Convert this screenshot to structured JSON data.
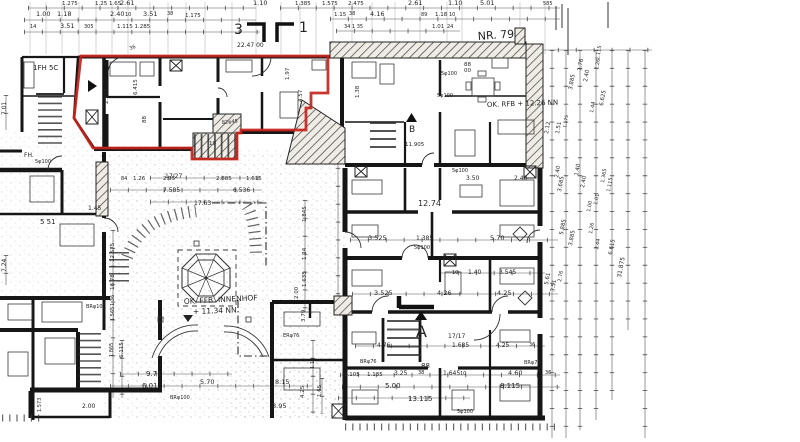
{
  "meta": {
    "sheet": "NR. 79",
    "drawing_type": "hand-drawn floor plan with highlighted unit"
  },
  "colors": {
    "paper": "#ffffff",
    "ink": "#1c1c1c",
    "dim": "#3c3c3c",
    "highlight": "#c6251c"
  },
  "highlight": {
    "points": "81,56 328,56 328,93 311,93 311,108 306,108 306,130 241,130 241,133 237,133 237,159 192,159 192,148 93,148 74,118"
  },
  "labels": [
    {
      "t": "1.275",
      "x": 62,
      "y": 5,
      "s": 5.5
    },
    {
      "t": "1.25 1.65",
      "x": 95,
      "y": 5,
      "s": 5.5
    },
    {
      "t": "2.61",
      "x": 120,
      "y": 5
    },
    {
      "t": "1.10",
      "x": 253,
      "y": 5
    },
    {
      "t": "1.00",
      "x": 36,
      "y": 16
    },
    {
      "t": "1.18",
      "x": 57,
      "y": 16
    },
    {
      "t": "2.40",
      "x": 110,
      "y": 16
    },
    {
      "t": "10",
      "x": 125,
      "y": 16,
      "s": 5
    },
    {
      "t": "3.51",
      "x": 143,
      "y": 16
    },
    {
      "t": "38",
      "x": 167,
      "y": 15,
      "s": 5
    },
    {
      "t": "1.175",
      "x": 185,
      "y": 17,
      "s": 5.5
    },
    {
      "t": "14",
      "x": 30,
      "y": 28,
      "s": 5
    },
    {
      "t": "3.51",
      "x": 60,
      "y": 28
    },
    {
      "t": "305",
      "x": 84,
      "y": 28,
      "s": 5
    },
    {
      "t": "1.115 1.285",
      "x": 117,
      "y": 28,
      "s": 5.5
    },
    {
      "t": "1.385",
      "x": 295,
      "y": 5,
      "s": 5.5
    },
    {
      "t": "1.575",
      "x": 322,
      "y": 5,
      "s": 5.5
    },
    {
      "t": "2.475",
      "x": 348,
      "y": 5,
      "s": 5.5
    },
    {
      "t": "2.61",
      "x": 408,
      "y": 5
    },
    {
      "t": "1.10",
      "x": 448,
      "y": 5
    },
    {
      "t": "5.01",
      "x": 480,
      "y": 5
    },
    {
      "t": "585",
      "x": 543,
      "y": 5,
      "s": 5
    },
    {
      "t": "1.15",
      "x": 334,
      "y": 16,
      "s": 5.5
    },
    {
      "t": "38",
      "x": 349,
      "y": 15,
      "s": 5
    },
    {
      "t": "4.16",
      "x": 370,
      "y": 16
    },
    {
      "t": "89",
      "x": 421,
      "y": 16,
      "s": 5
    },
    {
      "t": "1.18",
      "x": 435,
      "y": 16,
      "s": 5.5
    },
    {
      "t": "10",
      "x": 449,
      "y": 16,
      "s": 5
    },
    {
      "t": "34 1 35",
      "x": 344,
      "y": 28,
      "s": 5
    },
    {
      "t": "1.01",
      "x": 432,
      "y": 28,
      "s": 5.5
    },
    {
      "t": "24",
      "x": 447,
      "y": 28,
      "s": 5
    },
    {
      "t": "3",
      "x": 234,
      "y": 34,
      "s": 14
    },
    {
      "t": "1",
      "x": 299,
      "y": 32,
      "s": 14
    },
    {
      "t": "NR. 79",
      "x": 478,
      "y": 40,
      "s": 11,
      "r": -4
    },
    {
      "t": "22.47 00",
      "x": 237,
      "y": 47,
      "s": 6
    },
    {
      "t": "36",
      "x": 130,
      "y": 50,
      "s": 5,
      "r": -20
    },
    {
      "t": "1FH 5C",
      "x": 33,
      "y": 70,
      "s": 7
    },
    {
      "t": "OK. RFB + 12.26 NN",
      "x": 487,
      "y": 107,
      "s": 7,
      "r": -2
    },
    {
      "t": "B",
      "x": 409,
      "y": 132,
      "s": 9
    },
    {
      "t": "11.905",
      "x": 405,
      "y": 146,
      "s": 5.5
    },
    {
      "t": "OK. FFB. INNENHOF",
      "x": 184,
      "y": 304,
      "s": 7.5,
      "r": -3
    },
    {
      "t": "+ 11.34 NN",
      "x": 193,
      "y": 314,
      "s": 7.5,
      "r": -2
    },
    {
      "t": "A",
      "x": 416,
      "y": 337,
      "s": 16
    },
    {
      "t": "17/27",
      "x": 165,
      "y": 178,
      "s": 6
    },
    {
      "t": "17/17",
      "x": 448,
      "y": 338,
      "s": 6
    },
    {
      "t": "2.185",
      "x": 108,
      "y": 104,
      "r": -90,
      "s": 5.5
    },
    {
      "t": "6.415",
      "x": 137,
      "y": 95,
      "r": -90,
      "s": 5.5
    },
    {
      "t": "88",
      "x": 146,
      "y": 123,
      "r": -90,
      "s": 5.5
    },
    {
      "t": "1.97",
      "x": 289,
      "y": 80,
      "r": -90,
      "s": 5.5
    },
    {
      "t": "4.57",
      "x": 302,
      "y": 102,
      "r": -90,
      "s": 5.5
    },
    {
      "t": "1.38",
      "x": 359,
      "y": 98,
      "r": -90,
      "s": 5.5
    },
    {
      "t": "19",
      "x": 209,
      "y": 145,
      "s": 5.5
    },
    {
      "t": "82φ45",
      "x": 222,
      "y": 124,
      "s": 5,
      "r": -5
    },
    {
      "t": "84",
      "x": 121,
      "y": 180,
      "s": 5
    },
    {
      "t": "1.26",
      "x": 133,
      "y": 180,
      "s": 5.5
    },
    {
      "t": "2.95",
      "x": 163,
      "y": 180,
      "s": 5.5
    },
    {
      "t": "2.885",
      "x": 216,
      "y": 180,
      "s": 5.5
    },
    {
      "t": "1.615",
      "x": 246,
      "y": 180,
      "s": 5.5
    },
    {
      "t": "7.585",
      "x": 163,
      "y": 192,
      "s": 6
    },
    {
      "t": "6.536",
      "x": 233,
      "y": 192,
      "s": 6
    },
    {
      "t": "17.63",
      "x": 194,
      "y": 205,
      "s": 6
    },
    {
      "t": "FH.",
      "x": 24,
      "y": 157,
      "s": 6
    },
    {
      "t": "5 51",
      "x": 40,
      "y": 224,
      "s": 7
    },
    {
      "t": "1.45",
      "x": 88,
      "y": 210,
      "s": 6
    },
    {
      "t": "7.01",
      "x": 6,
      "y": 115,
      "r": -90,
      "s": 6
    },
    {
      "t": "7.24",
      "x": 6,
      "y": 272,
      "r": -90,
      "s": 6
    },
    {
      "t": "5φ100",
      "x": 441,
      "y": 75,
      "s": 5
    },
    {
      "t": "5φ100",
      "x": 437,
      "y": 97,
      "s": 5
    },
    {
      "t": "5φ100",
      "x": 35,
      "y": 163,
      "s": 5
    },
    {
      "t": "88",
      "x": 464,
      "y": 66,
      "s": 5.5
    },
    {
      "t": "00",
      "x": 464,
      "y": 72,
      "s": 5.5
    },
    {
      "t": "3.50",
      "x": 466,
      "y": 180,
      "s": 6
    },
    {
      "t": "2.40",
      "x": 514,
      "y": 180,
      "s": 6
    },
    {
      "t": "5φ100",
      "x": 452,
      "y": 172,
      "s": 5
    },
    {
      "t": "12.74",
      "x": 418,
      "y": 206,
      "s": 8
    },
    {
      "t": "3.525",
      "x": 368,
      "y": 240,
      "s": 6.5
    },
    {
      "t": "1.385",
      "x": 416,
      "y": 240,
      "s": 6
    },
    {
      "t": "5.70",
      "x": 490,
      "y": 240,
      "s": 6.5
    },
    {
      "t": "5φ100",
      "x": 414,
      "y": 249,
      "s": 5
    },
    {
      "t": "10",
      "x": 452,
      "y": 274,
      "s": 5
    },
    {
      "t": "1.40",
      "x": 468,
      "y": 274,
      "s": 6
    },
    {
      "t": "3.545",
      "x": 499,
      "y": 274,
      "s": 6
    },
    {
      "t": "3.525",
      "x": 374,
      "y": 295,
      "s": 6.5
    },
    {
      "t": "4.26",
      "x": 437,
      "y": 295,
      "s": 6.5
    },
    {
      "t": "4.25",
      "x": 497,
      "y": 295,
      "s": 6.5
    },
    {
      "t": "4.76",
      "x": 377,
      "y": 347,
      "s": 6
    },
    {
      "t": "1.685",
      "x": 452,
      "y": 347,
      "s": 6
    },
    {
      "t": "4.25",
      "x": 496,
      "y": 347,
      "s": 6
    },
    {
      "t": "36",
      "x": 529,
      "y": 346,
      "s": 5
    },
    {
      "t": "1.105",
      "x": 344,
      "y": 376,
      "s": 5.5
    },
    {
      "t": "1.135",
      "x": 367,
      "y": 376,
      "s": 5.5
    },
    {
      "t": "3.25",
      "x": 394,
      "y": 375,
      "s": 6
    },
    {
      "t": "38",
      "x": 418,
      "y": 374,
      "s": 5
    },
    {
      "t": "1.645",
      "x": 443,
      "y": 375,
      "s": 6
    },
    {
      "t": "88",
      "x": 421,
      "y": 368,
      "s": 7
    },
    {
      "t": "10",
      "x": 460,
      "y": 375,
      "s": 5
    },
    {
      "t": "4.60",
      "x": 508,
      "y": 375,
      "s": 6.5
    },
    {
      "t": "36",
      "x": 545,
      "y": 374,
      "s": 5
    },
    {
      "t": "5.00",
      "x": 385,
      "y": 388,
      "s": 7
    },
    {
      "t": "8.115",
      "x": 500,
      "y": 388,
      "s": 7
    },
    {
      "t": "13.115",
      "x": 408,
      "y": 401,
      "s": 7
    },
    {
      "t": "5φ100",
      "x": 457,
      "y": 413,
      "s": 5
    },
    {
      "t": "BRφ76",
      "x": 360,
      "y": 363,
      "s": 5
    },
    {
      "t": "BRφ70",
      "x": 524,
      "y": 364,
      "s": 5
    },
    {
      "t": "ERφ76",
      "x": 283,
      "y": 337,
      "s": 5
    },
    {
      "t": "9.71",
      "x": 146,
      "y": 376,
      "s": 7
    },
    {
      "t": "6.01",
      "x": 142,
      "y": 388,
      "s": 7
    },
    {
      "t": "5.70",
      "x": 200,
      "y": 384,
      "s": 6.5
    },
    {
      "t": "8.15",
      "x": 275,
      "y": 384,
      "s": 6.5
    },
    {
      "t": "8.95",
      "x": 272,
      "y": 408,
      "s": 6.5
    },
    {
      "t": "2.00",
      "x": 82,
      "y": 408,
      "s": 6
    },
    {
      "t": "1.573",
      "x": 41,
      "y": 412,
      "r": -90,
      "s": 5
    },
    {
      "t": "BRφ100",
      "x": 170,
      "y": 399,
      "s": 5
    },
    {
      "t": "BRφ100",
      "x": 86,
      "y": 308,
      "s": 5
    },
    {
      "t": "4.25",
      "x": 304,
      "y": 398,
      "r": -90,
      "s": 5.5
    },
    {
      "t": "1.65",
      "x": 321,
      "y": 397,
      "r": -90,
      "s": 5.5
    },
    {
      "t": "3.79",
      "x": 305,
      "y": 322,
      "r": -90,
      "s": 5.5
    },
    {
      "t": "1.14",
      "x": 314,
      "y": 369,
      "r": -90,
      "s": 5
    },
    {
      "t": "12.575",
      "x": 114,
      "y": 262,
      "r": -90,
      "s": 5.5
    },
    {
      "t": "16.78",
      "x": 114,
      "y": 290,
      "r": -90,
      "s": 5.5
    },
    {
      "t": "1.36",
      "x": 114,
      "y": 306,
      "r": -90,
      "s": 5
    },
    {
      "t": "1.565",
      "x": 114,
      "y": 321,
      "r": -90,
      "s": 5
    },
    {
      "t": "6.115",
      "x": 123,
      "y": 358,
      "r": -90,
      "s": 5.5
    },
    {
      "t": "1.865",
      "x": 113,
      "y": 357,
      "r": -90,
      "s": 5
    },
    {
      "t": "1.845",
      "x": 306,
      "y": 222,
      "r": -90,
      "s": 5.5
    },
    {
      "t": "1.24",
      "x": 306,
      "y": 260,
      "r": -90,
      "s": 5.5
    },
    {
      "t": "1.635",
      "x": 306,
      "y": 287,
      "r": -90,
      "s": 5.5
    },
    {
      "t": "2.00",
      "x": 298,
      "y": 299,
      "r": -90,
      "s": 5.5
    },
    {
      "t": "1.115",
      "x": 599,
      "y": 60,
      "r": -80,
      "s": 5
    },
    {
      "t": "1.26",
      "x": 598,
      "y": 70,
      "r": -80,
      "s": 5
    },
    {
      "t": "2.40",
      "x": 587,
      "y": 82,
      "r": -80,
      "s": 5.5
    },
    {
      "t": "1.76",
      "x": 581,
      "y": 71,
      "r": -80,
      "s": 5.5
    },
    {
      "t": "3.885",
      "x": 572,
      "y": 90,
      "r": -80,
      "s": 5.5
    },
    {
      "t": "6.625",
      "x": 603,
      "y": 106,
      "r": -80,
      "s": 5.5
    },
    {
      "t": "1.44",
      "x": 593,
      "y": 113,
      "r": -80,
      "s": 5
    },
    {
      "t": "2.12",
      "x": 548,
      "y": 134,
      "r": -80,
      "s": 5.5
    },
    {
      "t": "1.51",
      "x": 559,
      "y": 134,
      "r": -80,
      "s": 5.5
    },
    {
      "t": "1.175",
      "x": 566,
      "y": 128,
      "r": -80,
      "s": 4.5
    },
    {
      "t": "2.40",
      "x": 558,
      "y": 178,
      "r": -80,
      "s": 5.5
    },
    {
      "t": "3.685",
      "x": 561,
      "y": 192,
      "r": -80,
      "s": 5.5
    },
    {
      "t": "1.40",
      "x": 578,
      "y": 176,
      "r": -80,
      "s": 5.5
    },
    {
      "t": "2.40",
      "x": 584,
      "y": 188,
      "r": -80,
      "s": 5.5
    },
    {
      "t": "5.885",
      "x": 563,
      "y": 235,
      "r": -80,
      "s": 5.5
    },
    {
      "t": "3.885",
      "x": 572,
      "y": 246,
      "r": -80,
      "s": 5.5
    },
    {
      "t": "1.26",
      "x": 592,
      "y": 234,
      "r": -80,
      "s": 5
    },
    {
      "t": "1.01",
      "x": 597,
      "y": 205,
      "r": -80,
      "s": 5
    },
    {
      "t": "1.00",
      "x": 590,
      "y": 212,
      "r": -80,
      "s": 5
    },
    {
      "t": "1.44",
      "x": 598,
      "y": 250,
      "r": -80,
      "s": 5
    },
    {
      "t": "1.365",
      "x": 604,
      "y": 183,
      "r": -80,
      "s": 5
    },
    {
      "t": "1.115",
      "x": 610,
      "y": 192,
      "r": -80,
      "s": 5
    },
    {
      "t": "6.615",
      "x": 612,
      "y": 255,
      "r": -80,
      "s": 5.5
    },
    {
      "t": "31.875",
      "x": 621,
      "y": 278,
      "r": -80,
      "s": 6
    },
    {
      "t": "5.61",
      "x": 548,
      "y": 285,
      "r": -80,
      "s": 5.5
    },
    {
      "t": "3.51",
      "x": 554,
      "y": 292,
      "r": -80,
      "s": 5.5
    },
    {
      "t": "2.76",
      "x": 561,
      "y": 282,
      "r": -80,
      "s": 5
    }
  ]
}
